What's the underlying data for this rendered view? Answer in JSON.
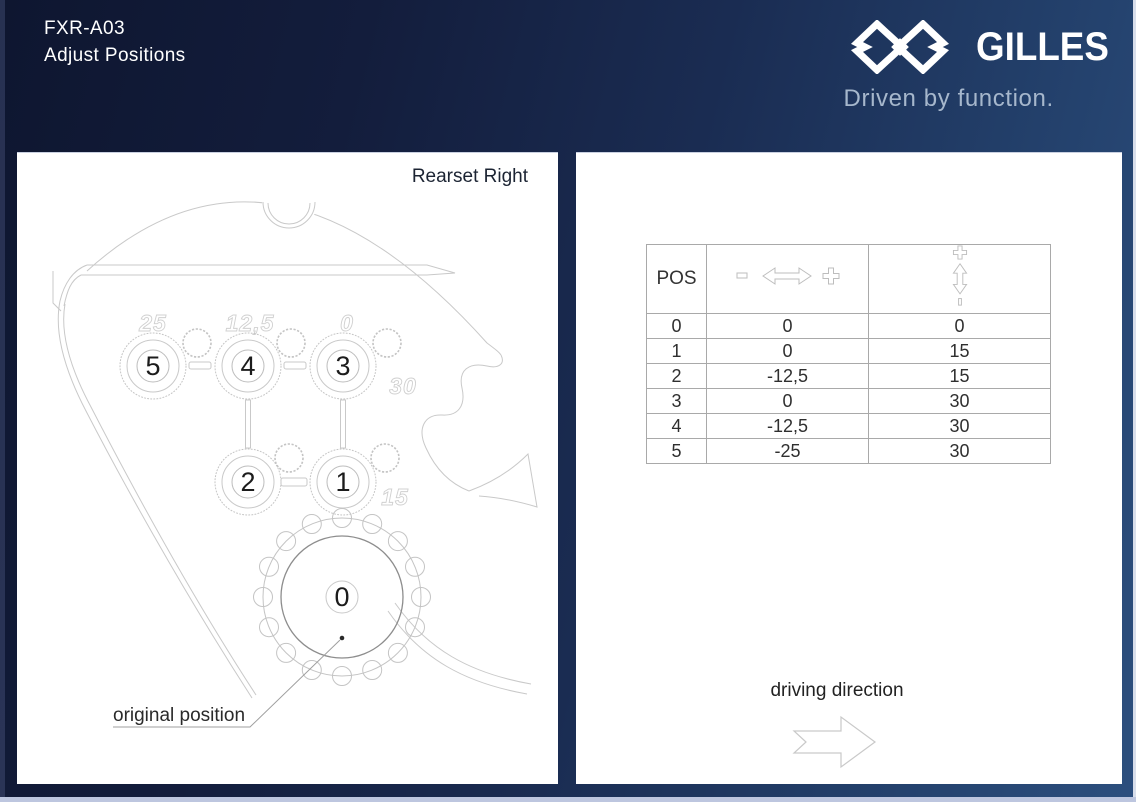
{
  "header": {
    "model": "FXR-A03",
    "subtitle": "Adjust Positions"
  },
  "brand": {
    "name": "GILLES",
    "tagline": "Driven by function.",
    "logo_icon": "gilles-interlocked-diamonds-icon"
  },
  "left_panel": {
    "title": "Rearset Right",
    "drawing": {
      "circle_labels": [
        "5",
        "4",
        "3",
        "2",
        "1"
      ],
      "center_label": "0",
      "engraved": [
        "25",
        "12,5",
        "0",
        "30",
        "15"
      ],
      "annotation": "original position"
    }
  },
  "right_panel": {
    "table": {
      "pos_header": "POS",
      "icons": {
        "horizontal": "horizontal-offset-arrow-icon",
        "vertical": "vertical-offset-arrow-icon"
      },
      "rows": [
        [
          "0",
          "0",
          "0"
        ],
        [
          "1",
          "0",
          "15"
        ],
        [
          "2",
          "-12,5",
          "15"
        ],
        [
          "3",
          "0",
          "30"
        ],
        [
          "4",
          "-12,5",
          "30"
        ],
        [
          "5",
          "-25",
          "30"
        ]
      ]
    },
    "driving_direction_label": "driving direction",
    "driving_arrow_icon": "right-arrow-icon"
  },
  "colors": {
    "background_dark": "#101833",
    "background_light": "#2b4d7e",
    "panel": "#ffffff",
    "bottom_strip": "#bdc6df",
    "drawing_line": "#c9c9c9",
    "table_border": "#a9a9a9",
    "tagline_text": "#a6b7cc"
  }
}
